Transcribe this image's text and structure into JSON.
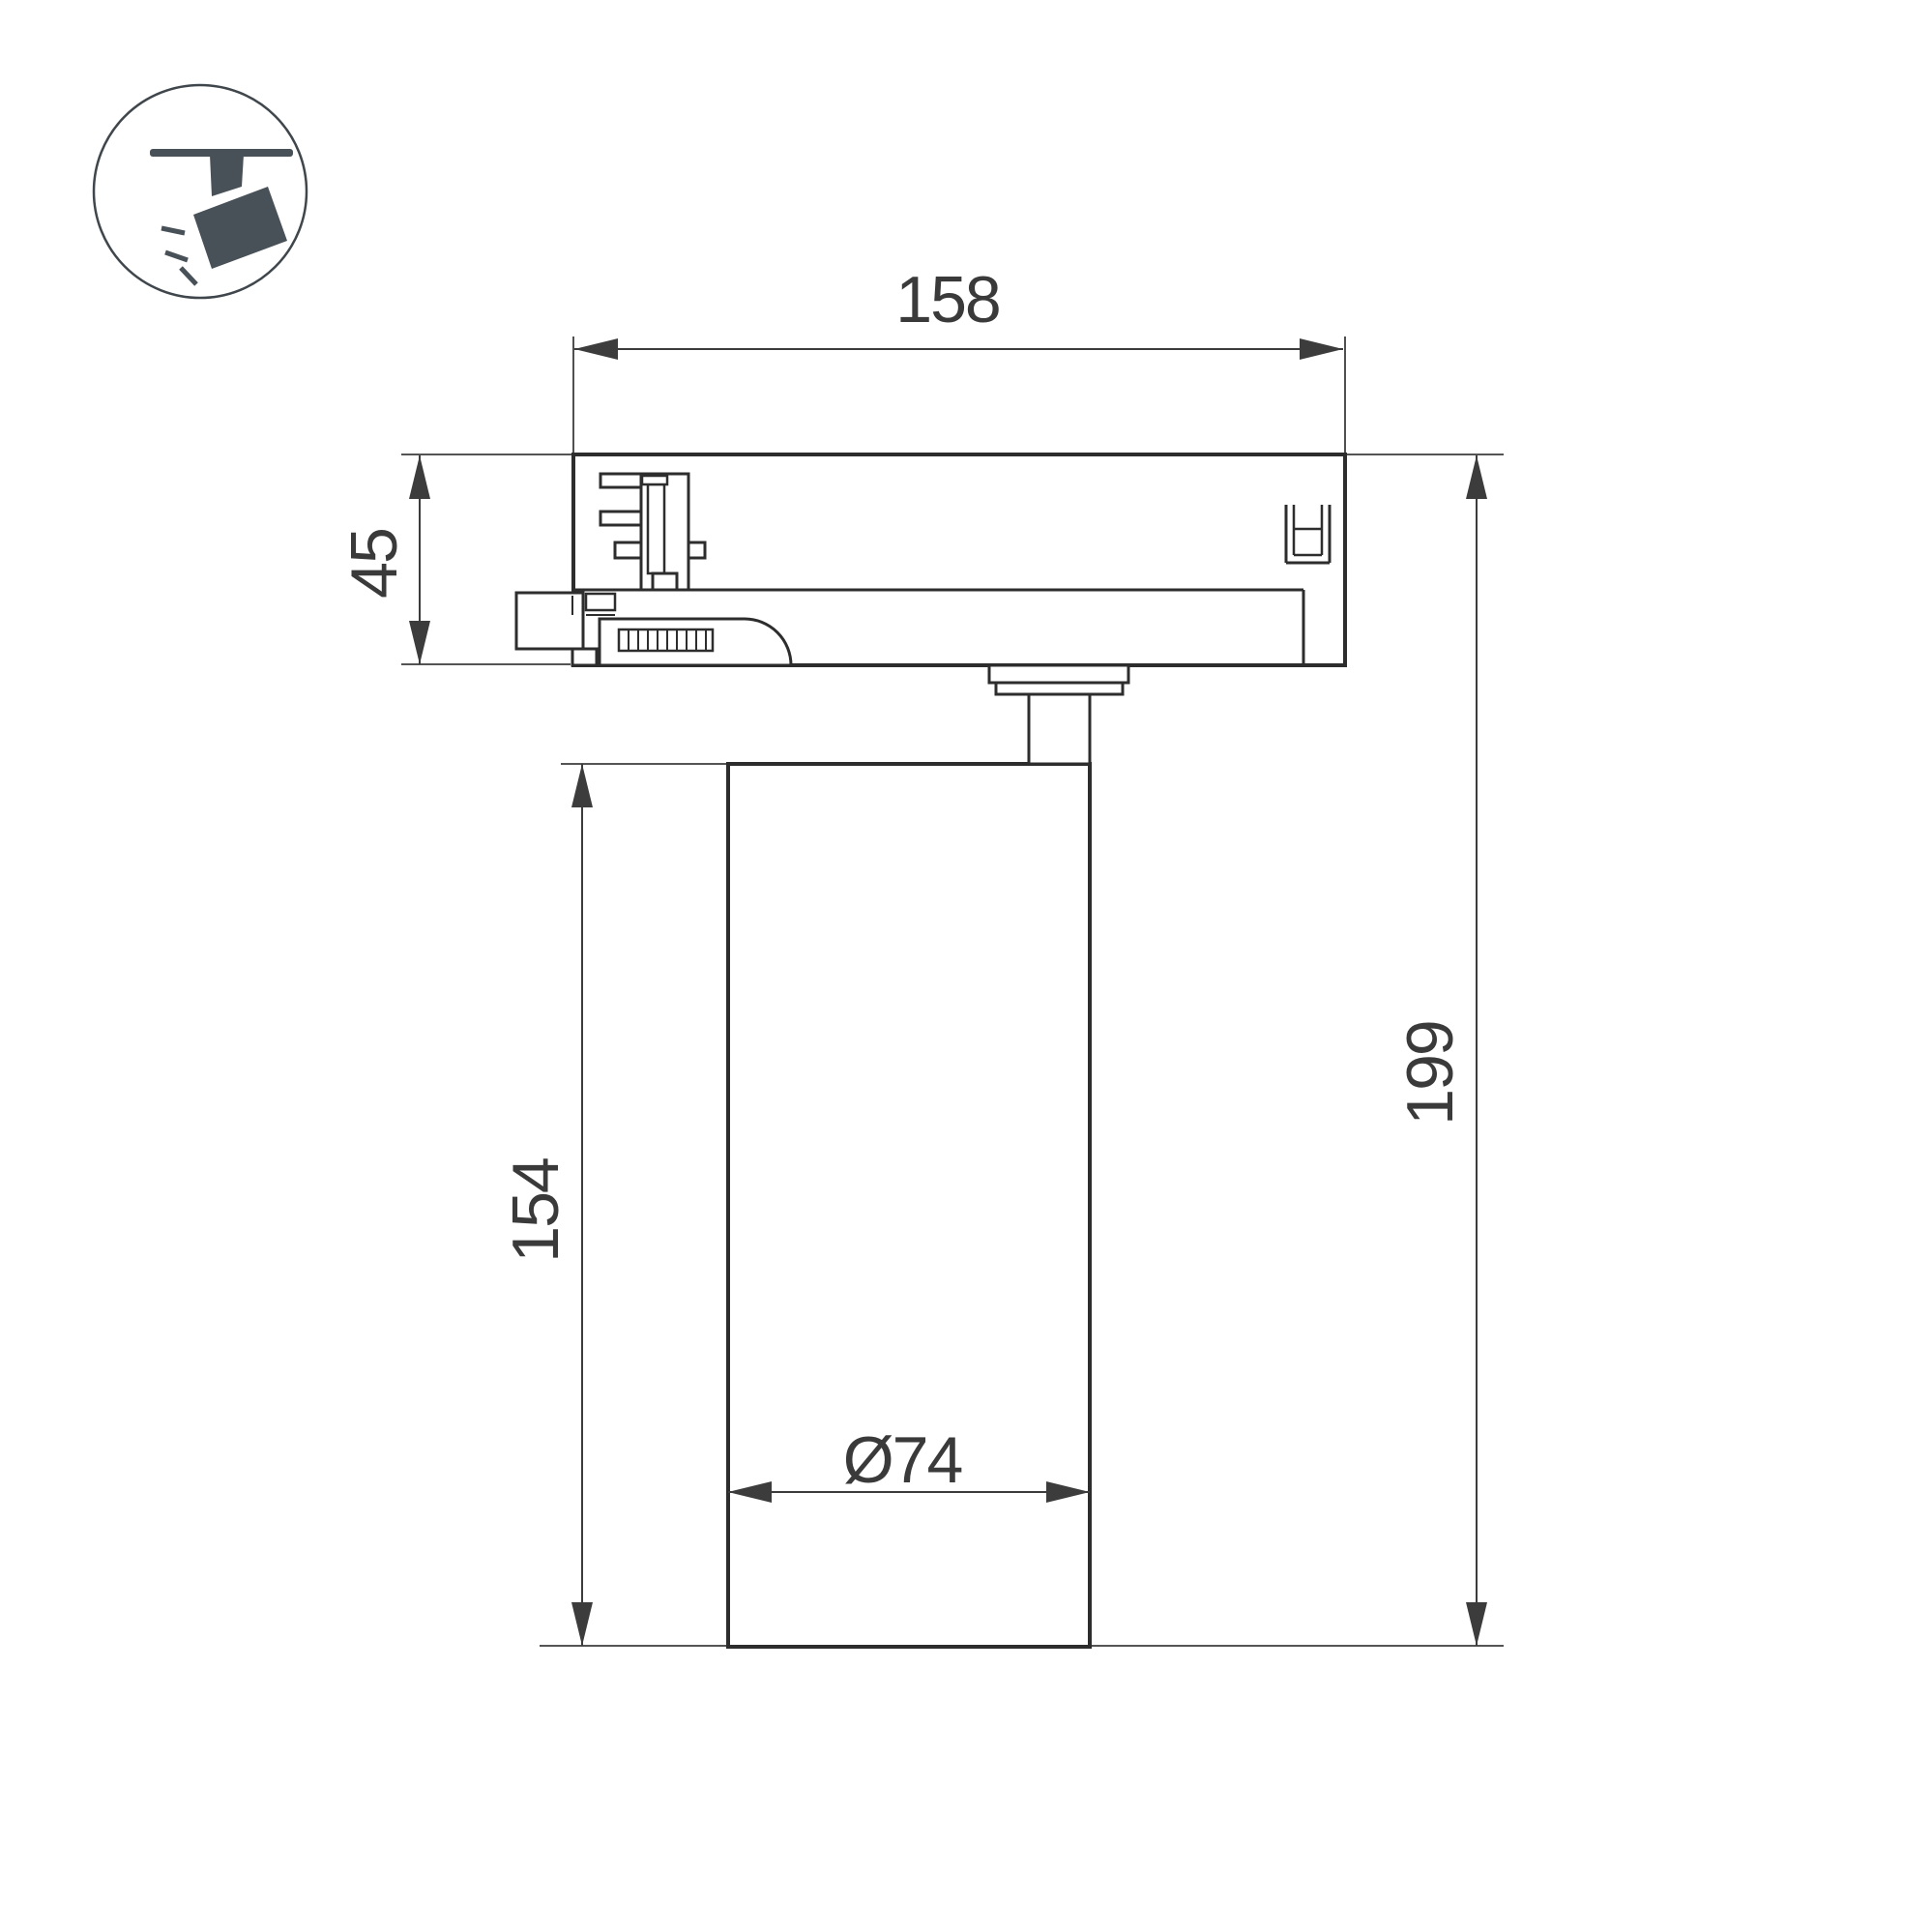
{
  "icon": {
    "name": "ceiling-track-spotlight",
    "fill": "#495158"
  },
  "drawing": {
    "labels": {
      "track_width": "158",
      "adapter_height": "45",
      "body_height": "154",
      "total_height": "199",
      "body_diameter": "Ø74"
    },
    "colors": {
      "outline": "#2d2d2d",
      "dimension": "#3c3c3c",
      "text": "#3a3a3a",
      "background": "#ffffff"
    }
  }
}
